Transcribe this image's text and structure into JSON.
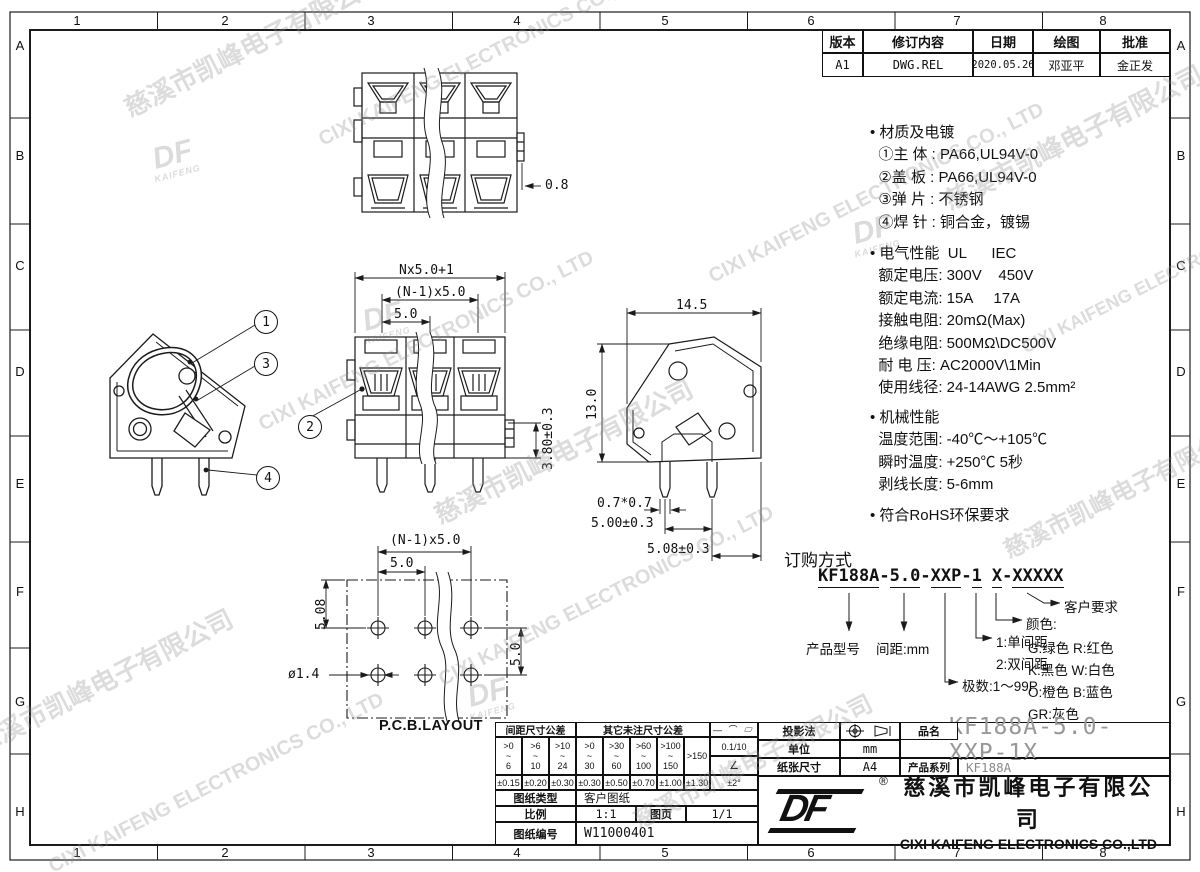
{
  "sheet": {
    "cols": [
      "1",
      "2",
      "3",
      "4",
      "5",
      "6",
      "7",
      "8"
    ],
    "rows": [
      "A",
      "B",
      "C",
      "D",
      "E",
      "F",
      "G",
      "H"
    ]
  },
  "watermark": {
    "cn": "慈溪市凯峰电子有限公司",
    "en": "CIXI KAIFENG ELECTRONICS CO., LTD",
    "logo_main": "DF",
    "logo_sub": "KAIFENG"
  },
  "revision": {
    "headers": [
      "版本",
      "修订内容",
      "日期",
      "绘图",
      "批准"
    ],
    "row": {
      "version": "A1",
      "content": "DWG.REL",
      "date": "2020.05.26",
      "drawn": "邓亚平",
      "approved": "金正发"
    }
  },
  "specs": {
    "materials": "• 材质及电镀\n  ①主 体 : PA66,UL94V-0\n  ②盖 板 : PA66,UL94V-0\n  ③弹 片 : 不锈钢\n  ④焊 针 : 铜合金，镀锡",
    "electrical": "• 电气性能  UL      IEC\n  额定电压: 300V    450V\n  额定电流: 15A     17A\n  接触电阻: 20mΩ(Max)\n  绝缘电阻: 500MΩ\\DC500V\n  耐 电 压: AC2000V\\1Min\n  使用线径: 24-14AWG 2.5mm²",
    "mechanical": "• 机械性能\n  温度范围: -40℃～+105℃\n  瞬时温度: +250℃ 5秒\n  剥线长度: 5-6mm",
    "rohs": "• 符合RoHS环保要求"
  },
  "dims": {
    "top_view": "0.8",
    "front_total": "Nx5.0+1",
    "front_span": "(N-1)x5.0",
    "front_pitch": "5.0",
    "front_depth": "3.80±0.3",
    "side_width": "14.5",
    "side_height": "13.0",
    "pin_size": "0.7*0.7",
    "pin_pitch": "5.00±0.3",
    "pin_face": "5.08±0.3",
    "pcb_span": "(N-1)x5.0",
    "pcb_pitch": "5.0",
    "pcb_row_offset": "5.08",
    "pcb_row_pitch": "5.0",
    "pcb_hole": "ø1.4",
    "pcb_title": "P.C.B.LAYOUT"
  },
  "balloons": {
    "b1": "1",
    "b2": "2",
    "b3": "3",
    "b4": "4"
  },
  "ordering": {
    "title": "订购方式",
    "parts": [
      "KF188A",
      "-",
      "5.0",
      "-",
      "XXP",
      "-",
      "1",
      "X",
      "-",
      "XXXXX"
    ],
    "product_model": "产品型号",
    "pitch": "间距:mm",
    "poles": "极数:1～99P",
    "opt1": "1:单间距",
    "opt2": "2:双间距",
    "color_title": "颜色:",
    "colors": [
      "G:绿色  R:红色",
      "K:黑色  W:白色",
      "O:橙色  B:蓝色",
      "GR:灰色"
    ],
    "customer": "客户要求"
  },
  "title_block": {
    "pitch_tol_header": "间距尺寸公差",
    "other_tol_header": "其它未注尺寸公差",
    "pitch_ranges": [
      ">0\n~\n6",
      ">6\n~\n10",
      ">10\n~\n24"
    ],
    "other_ranges": [
      ">0\n~\n30",
      ">30\n~\n60",
      ">60\n~\n100",
      ">100\n~\n150"
    ],
    "over150": ">150",
    "pitch_tols": [
      "±0.15",
      "±0.20",
      "±0.30"
    ],
    "other_tols": [
      "±0.30",
      "±0.50",
      "±0.70",
      "±1.00",
      "±1.30"
    ],
    "geo_symbols": "— ⌒ ▱",
    "flat_tol": "0.1/10",
    "angle_icon": "∠",
    "angle_tol": "±2°",
    "type_label": "图纸类型",
    "type_value": "客户图纸",
    "scale_label": "比例",
    "scale_value": "1:1",
    "page_label": "图页",
    "page_value": "1/1",
    "no_label": "图纸编号",
    "no_value": "W11000401",
    "projection_label": "投影法",
    "unit_label": "单位",
    "unit_value": "mm",
    "paper_label": "纸张尺寸",
    "paper_value": "A4",
    "name_label": "品名",
    "name_value": "KF188A-5.0-XXP-1X",
    "series_label": "产品系列",
    "series_value": "KF188A",
    "registered": "®",
    "company_cn": "慈溪市凯峰电子有限公司",
    "company_en": "CIXI KAIFENG ELECTRONICS CO.,LTD"
  }
}
